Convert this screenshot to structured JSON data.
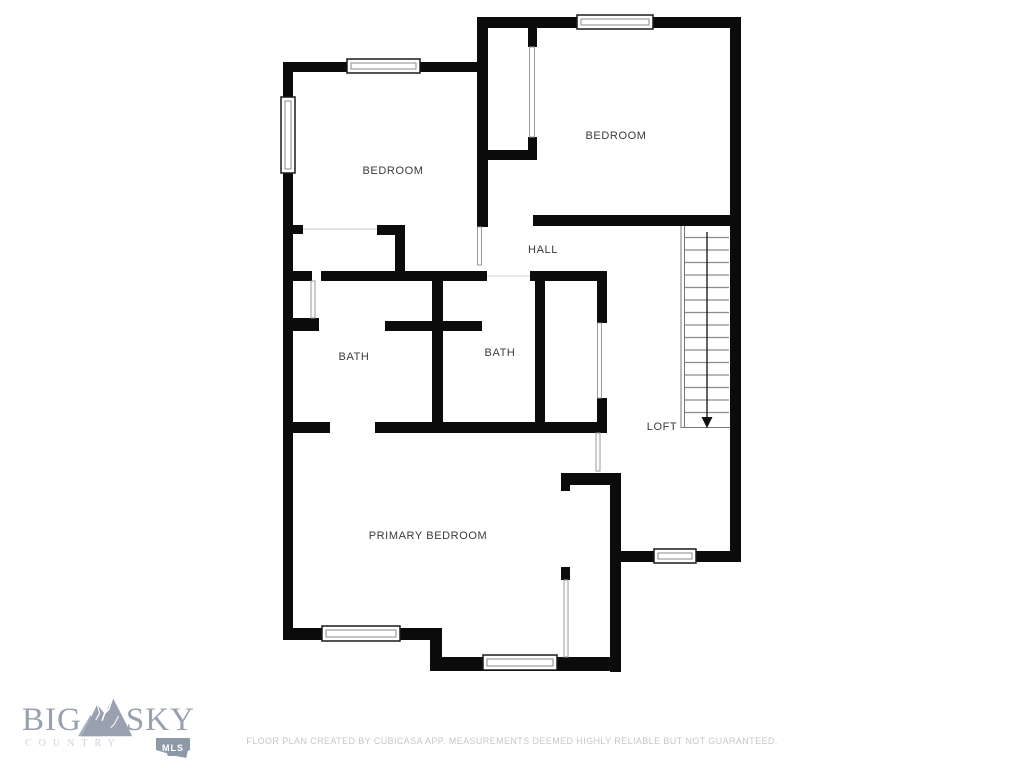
{
  "floor_plan": {
    "rooms": [
      {
        "id": "bedroom-left",
        "label": "BEDROOM"
      },
      {
        "id": "bedroom-right",
        "label": "BEDROOM"
      },
      {
        "id": "hall",
        "label": "HALL"
      },
      {
        "id": "bath-left",
        "label": "BATH"
      },
      {
        "id": "bath-right",
        "label": "BATH"
      },
      {
        "id": "loft",
        "label": "LOFT"
      },
      {
        "id": "primary-bedroom",
        "label": "PRIMARY BEDROOM"
      }
    ],
    "stairs": {
      "direction": "down"
    },
    "colors": {
      "wall": "#0b0b0b",
      "label": "#3a3a3a",
      "background": "#ffffff"
    }
  },
  "branding": {
    "word_left": "BIG",
    "word_right": "SKY",
    "tagline": "COUNTRY",
    "badge_label": "MLS",
    "colors": {
      "logo_text": "#99a1b1",
      "tagline": "#ced3da",
      "badge_bg": "#8e99a8",
      "badge_text": "#ffffff"
    }
  },
  "footer": {
    "disclaimer": "FLOOR PLAN CREATED BY CUBICASA APP. MEASUREMENTS DEEMED HIGHLY RELIABLE BUT NOT GUARANTEED."
  }
}
